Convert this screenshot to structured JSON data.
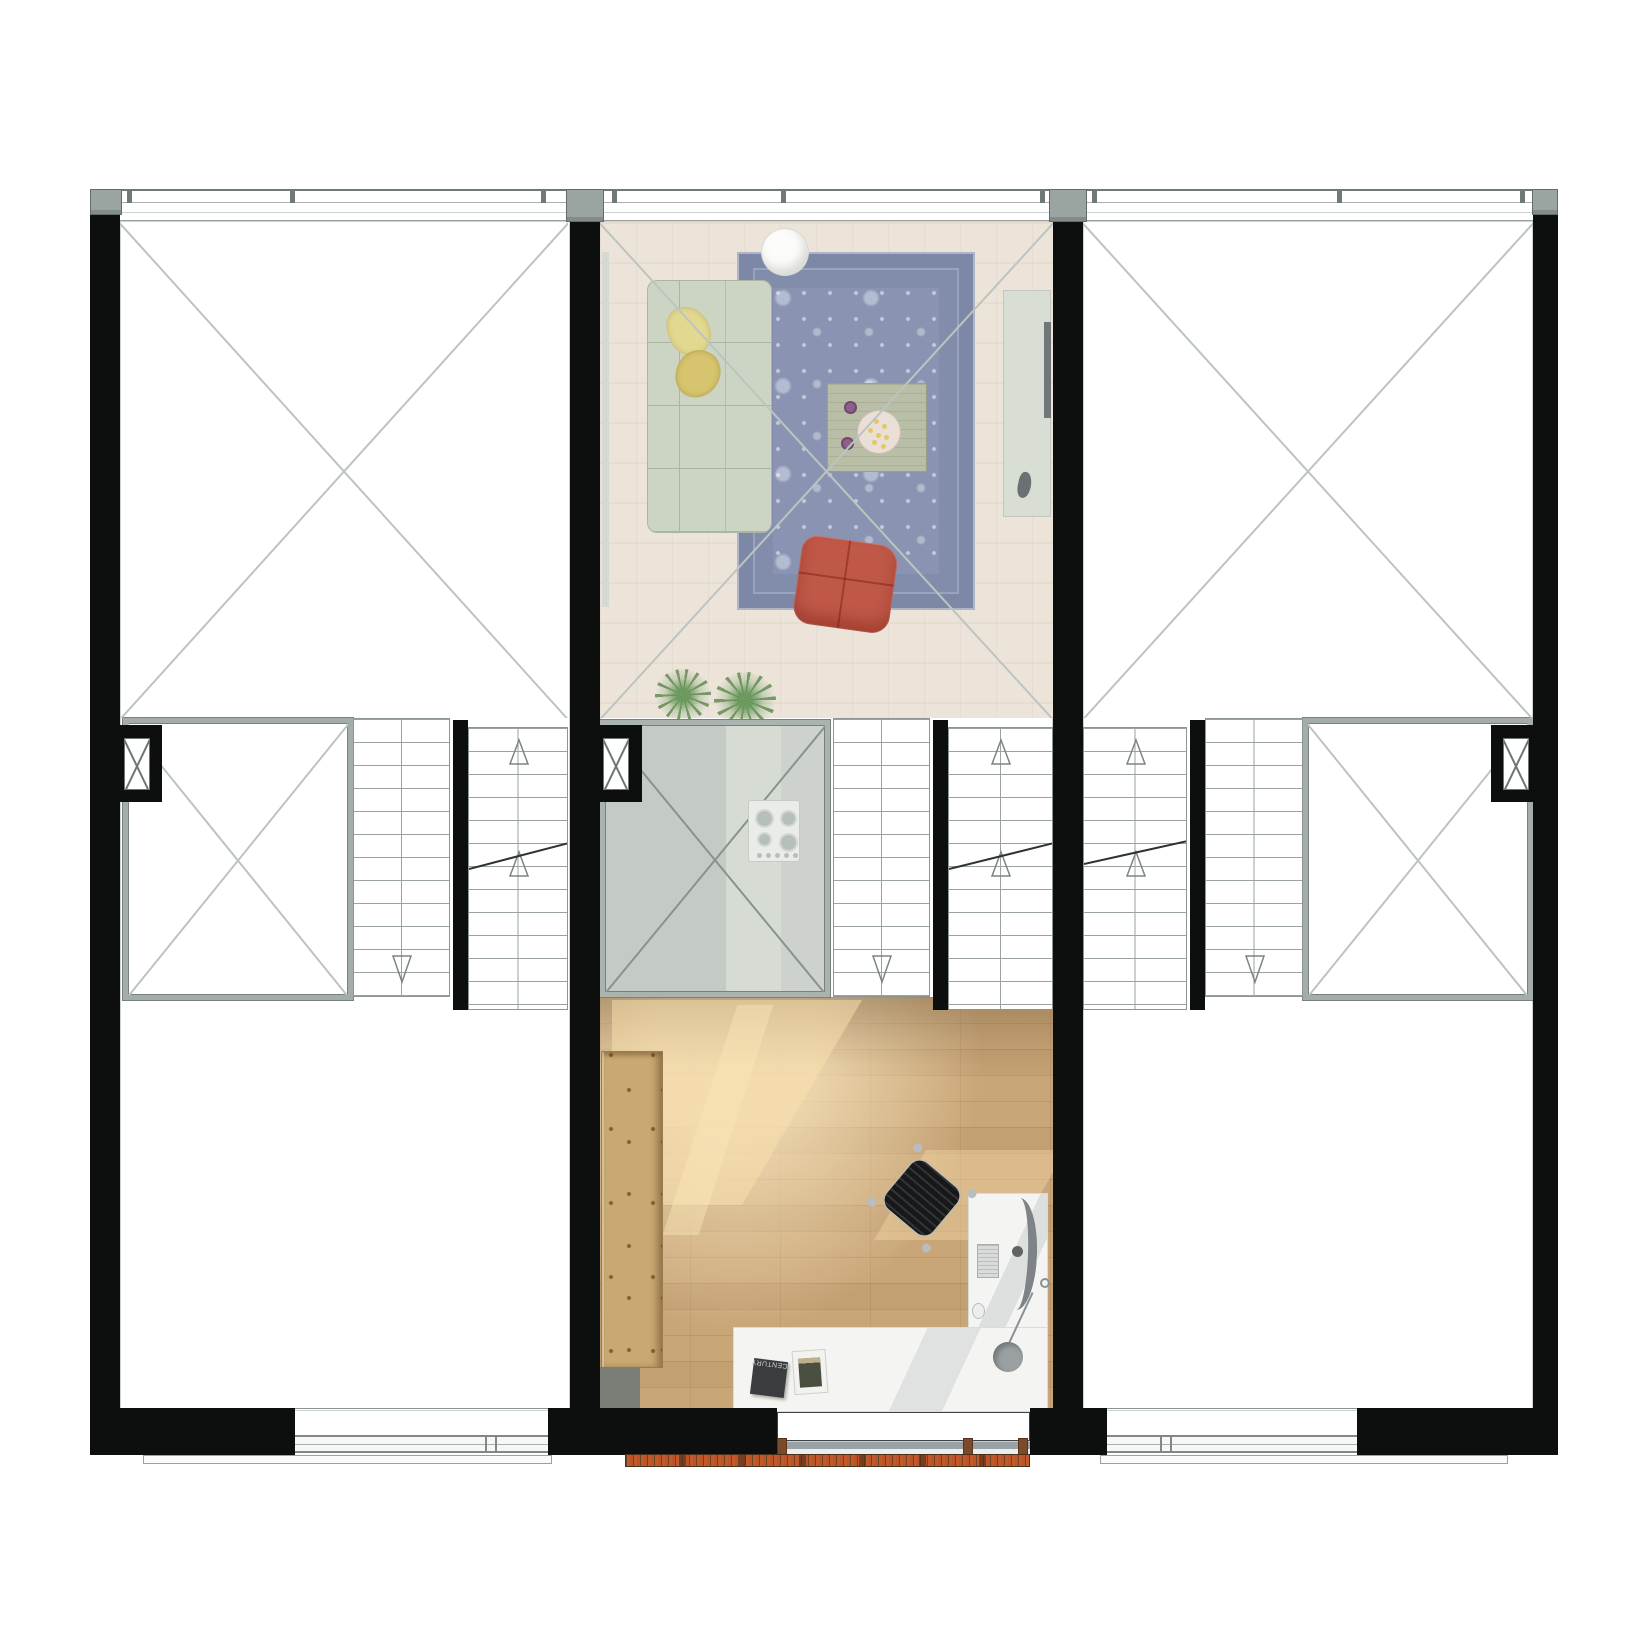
{
  "document": {
    "type": "architectural floor plan, top-down render, three row-house units",
    "visible_text": {
      "book_label": "CENTURY"
    }
  },
  "icons": {
    "stair-up-arrow": "open triangle pointing up",
    "stair-down-arrow": "open triangle pointing down",
    "void-cross": "X diagonals marking void / double-height space",
    "shaft-cross": "small X box (duct/shaft) in wall poche"
  },
  "colors": {
    "bg": "#ffffff",
    "wall": "#0d0e0e",
    "cap": "#9aa5a2",
    "cap-edge": "#636e6b",
    "line-faint": "#ccd2d1",
    "line-dark": "#78817e",
    "line-x": "#bcc4c2",
    "cut": "#2e3331",
    "void-border": "#a4adaa",
    "stair-line": "#9aa2a2",
    "stair-edge": "#8d9594",
    "arrow": "#7c8583",
    "frame": "#7f8886",
    "tick": "#6f7977",
    "sill": "#fbfbfa",
    "living-floor": "#ece4d9",
    "rug-field": "#8a94b2",
    "rug-border": "#7d88a6",
    "rug-trim": "#aeb5c8",
    "sofa": "#ccd4c4",
    "sofa-seam": "#a9b6a2",
    "pillow1": "#e2d88f",
    "pillow2": "#d6c46f",
    "table-wood": "#b9bfa6",
    "tray": "#eadfd6",
    "tray-dot": "#e6c766",
    "plum": "#8d6087",
    "chair-red": "#c05848",
    "pendant": "#fcfcfb",
    "sideboard": "#d9ded5",
    "tv": "#70777a",
    "kitchen1": "#c4cbc4",
    "kitchen2": "#d6dbd4",
    "kitchen-border": "#aab3ae",
    "cooktop": "#eaece8",
    "burner": "#b7bfba",
    "plant": "#6f9e63",
    "office-floor": "#c9a678",
    "office-glow": "#f2d9a8",
    "shelf": "#c9a873",
    "shelf-dot": "#8a5a33",
    "shelf-shadow": "#7b7e76",
    "desk": "#f4f5f2",
    "monitor": "#7d8386",
    "chrome": "#b9bdc0",
    "chair-black": "#17181a",
    "lamp": "#9ba1a3",
    "book-black": "#3a3d3f",
    "book-text": "#cfd3d4",
    "photo": "#49503f",
    "glass": "#535a60",
    "glass-light": "#9aa1a5",
    "post": "#7b4a2a",
    "brick": "#bb5429",
    "brick-dark": "#6b4426"
  }
}
